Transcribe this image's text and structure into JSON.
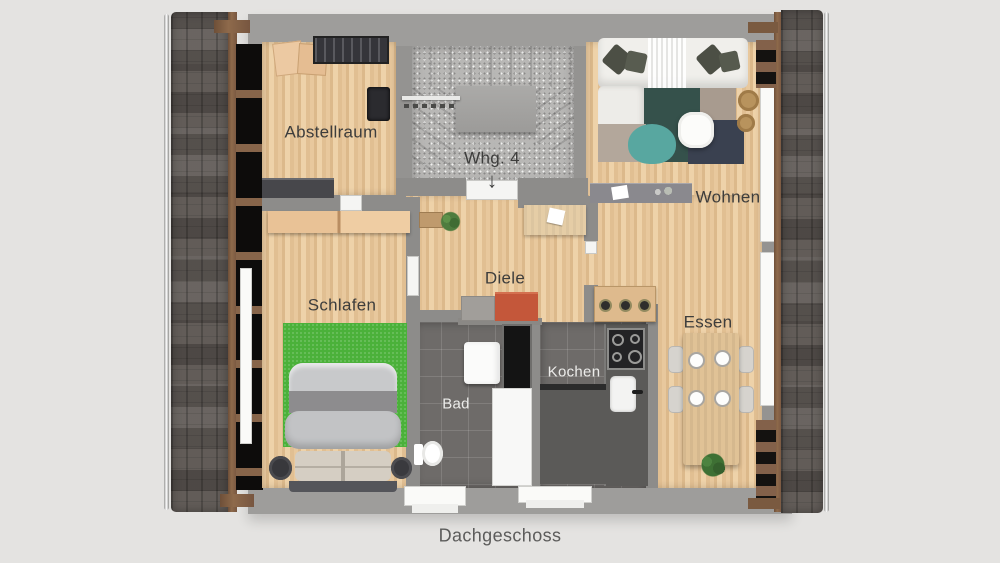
{
  "caption": "Dachgeschoss",
  "unit": {
    "label": "Whg. 4",
    "arrow": "↓"
  },
  "rooms": {
    "abstellraum": {
      "label": "Abstellraum"
    },
    "schlafen": {
      "label": "Schlafen"
    },
    "diele": {
      "label": "Diele"
    },
    "wohnen": {
      "label": "Wohnen"
    },
    "bad": {
      "label": "Bad"
    },
    "kochen": {
      "label": "Kochen"
    },
    "essen": {
      "label": "Essen"
    }
  },
  "colors": {
    "background": "#e4e3e1",
    "outer_wall": "#9c9b99",
    "inner_wall": "#8d8c8a",
    "wood_floor": "#e3c294",
    "tile_floor": "#6e6b69",
    "stair_floor": "#b8b7b5",
    "roof_shingles": "#58524e",
    "rafter_wood": "#87654a",
    "rug_green": "#4bb13a",
    "rug_teal": "#58a7a0",
    "rug_navy": "#3a4150",
    "bench_orange": "#c4573a",
    "label_text": "#3d3d3c",
    "caption_text": "#5c5c5b"
  }
}
